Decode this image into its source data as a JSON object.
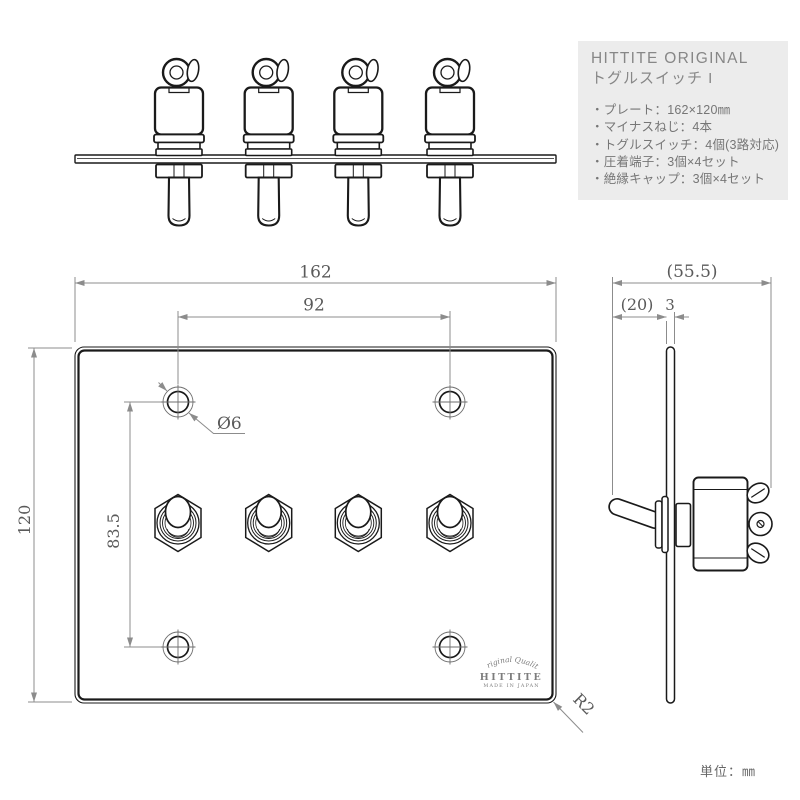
{
  "info_box": {
    "title_line1": "HITTITE ORIGINAL",
    "title_line2": "トグルスイッチ I",
    "items": [
      "・プレート：162×120㎜",
      "・マイナスねじ：4本",
      "・トグルスイッチ：4個(3路対応)",
      "・圧着端子：3個×4セット",
      "・絶縁キャップ：3個×4セット"
    ]
  },
  "dimensions": {
    "front": {
      "plate_width": "162",
      "hole_pitch_h": "92",
      "plate_height": "120",
      "hole_pitch_v": "83.5",
      "hole_dia": "Ø6",
      "corner_radius": "R2"
    },
    "side": {
      "total_depth": "(55.5)",
      "lever_projection": "(20)",
      "plate_thickness": "3"
    }
  },
  "logo": {
    "arc_text": "Original Quality",
    "name": "HITTITE",
    "sub_text": "MADE IN JAPAN"
  },
  "unit_note": "単位：㎜",
  "colors": {
    "object_line": "#1a1a1a",
    "dimension_line": "#8c8c8c",
    "dimension_text": "#5a5a5a",
    "info_box_bg": "#ececec",
    "info_text": "#767676"
  }
}
